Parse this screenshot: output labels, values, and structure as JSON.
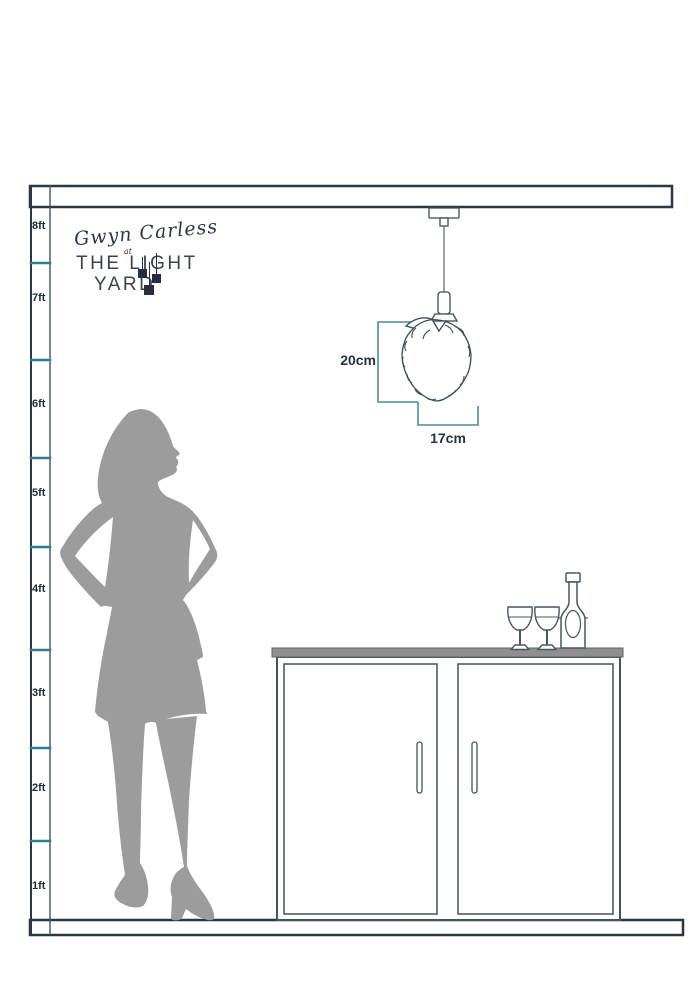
{
  "brand": {
    "script_name": "Gwyn Carless",
    "conjunction": "at",
    "name_line1": "THE LIGHT",
    "name_line2": "YARD"
  },
  "ruler": {
    "labels": [
      "8ft",
      "7ft",
      "6ft",
      "5ft",
      "4ft",
      "3ft",
      "2ft",
      "1ft"
    ]
  },
  "pendant": {
    "height_label": "20cm",
    "width_label": "17cm"
  },
  "colors": {
    "dimension_teal": "#4d8aa0",
    "tick_teal": "#2f7d96",
    "outline_navy": "#2a3844",
    "drawing_gray": "#44525c",
    "silhouette_gray": "#9c9c9c",
    "countertop_gray": "#8f8f8f",
    "logo_navy": "#242e3c"
  }
}
